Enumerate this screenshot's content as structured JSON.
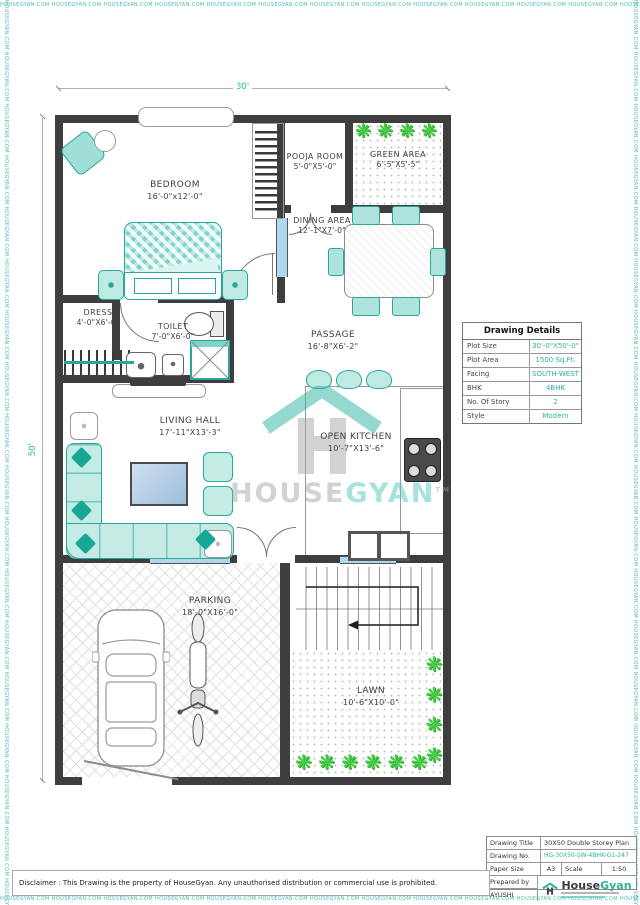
{
  "watermark": {
    "border_text": "HOUSEGYAN.COM"
  },
  "brand_center": {
    "house": "HOUSE",
    "gyan": "GYAN",
    "tm": "TM"
  },
  "dims": {
    "width_label": "30'",
    "height_label": "50'"
  },
  "rooms": {
    "bedroom": {
      "name": "BEDROOM",
      "size": "16'-0\"x12'-0\""
    },
    "pooja": {
      "name": "POOJA ROOM",
      "size": "5'-0\"X5'-0\""
    },
    "green": {
      "name": "GREEN AREA",
      "size": "6'-5\"X5'-5\""
    },
    "dining": {
      "name": "DINING AREA",
      "size": "12'-1\"X7'-0\""
    },
    "dress": {
      "name": "DRESS",
      "size": "4'-0\"X6'-0\""
    },
    "toilet": {
      "name": "TOILET",
      "size": "7'-0\"X6'-0\""
    },
    "passage": {
      "name": "PASSAGE",
      "size": "16'-8\"X6'-2\""
    },
    "living": {
      "name": "LIVING HALL",
      "size": "17'-11\"X13'-3\""
    },
    "kitchen": {
      "name": "OPEN KITCHEN",
      "size": "10'-7\"X13'-6\""
    },
    "parking": {
      "name": "PARKING",
      "size": "18'-0\"X16'-0\""
    },
    "lawn": {
      "name": "LAWN",
      "size": "10'-6\"X10'-0\""
    }
  },
  "details": {
    "title": "Drawing Details",
    "rows": [
      {
        "label": "Plot Size",
        "value": "30'-0\"X50'-0\""
      },
      {
        "label": "Plot Area",
        "value": "1500 Sq.Ft."
      },
      {
        "label": "Facing",
        "value": "SOUTH-WEST"
      },
      {
        "label": "BHK",
        "value": "4BHK"
      },
      {
        "label": "No. Of Story",
        "value": "2"
      },
      {
        "label": "Style",
        "value": "Modern"
      }
    ]
  },
  "titleblock": {
    "drawing_title_label": "Drawing Title",
    "drawing_title": "30X50 Double Storey Plan",
    "drawing_no_label": "Drawing No.",
    "drawing_no": "HG-30X50-SW-4BHK-G1-247",
    "paper_size_label": "Paper Size",
    "paper_size": "A3",
    "scale_label": "Scale",
    "scale_value": "1:50",
    "prepared_by_label": "Prepared by",
    "prepared_by": "AYUSHI",
    "brand_house": "House",
    "brand_gyan": "Gyan"
  },
  "footer": {
    "disclaimer": "Disclaimer : This Drawing is the property of HouseGyan. Any unauthorised distribution or commercial use is prohibited."
  },
  "icons": {
    "plant": "❋"
  },
  "colors": {
    "accent_teal": "#2db3a0",
    "wall_dark": "#3e3e3e",
    "plant_green": "#46cc46"
  }
}
